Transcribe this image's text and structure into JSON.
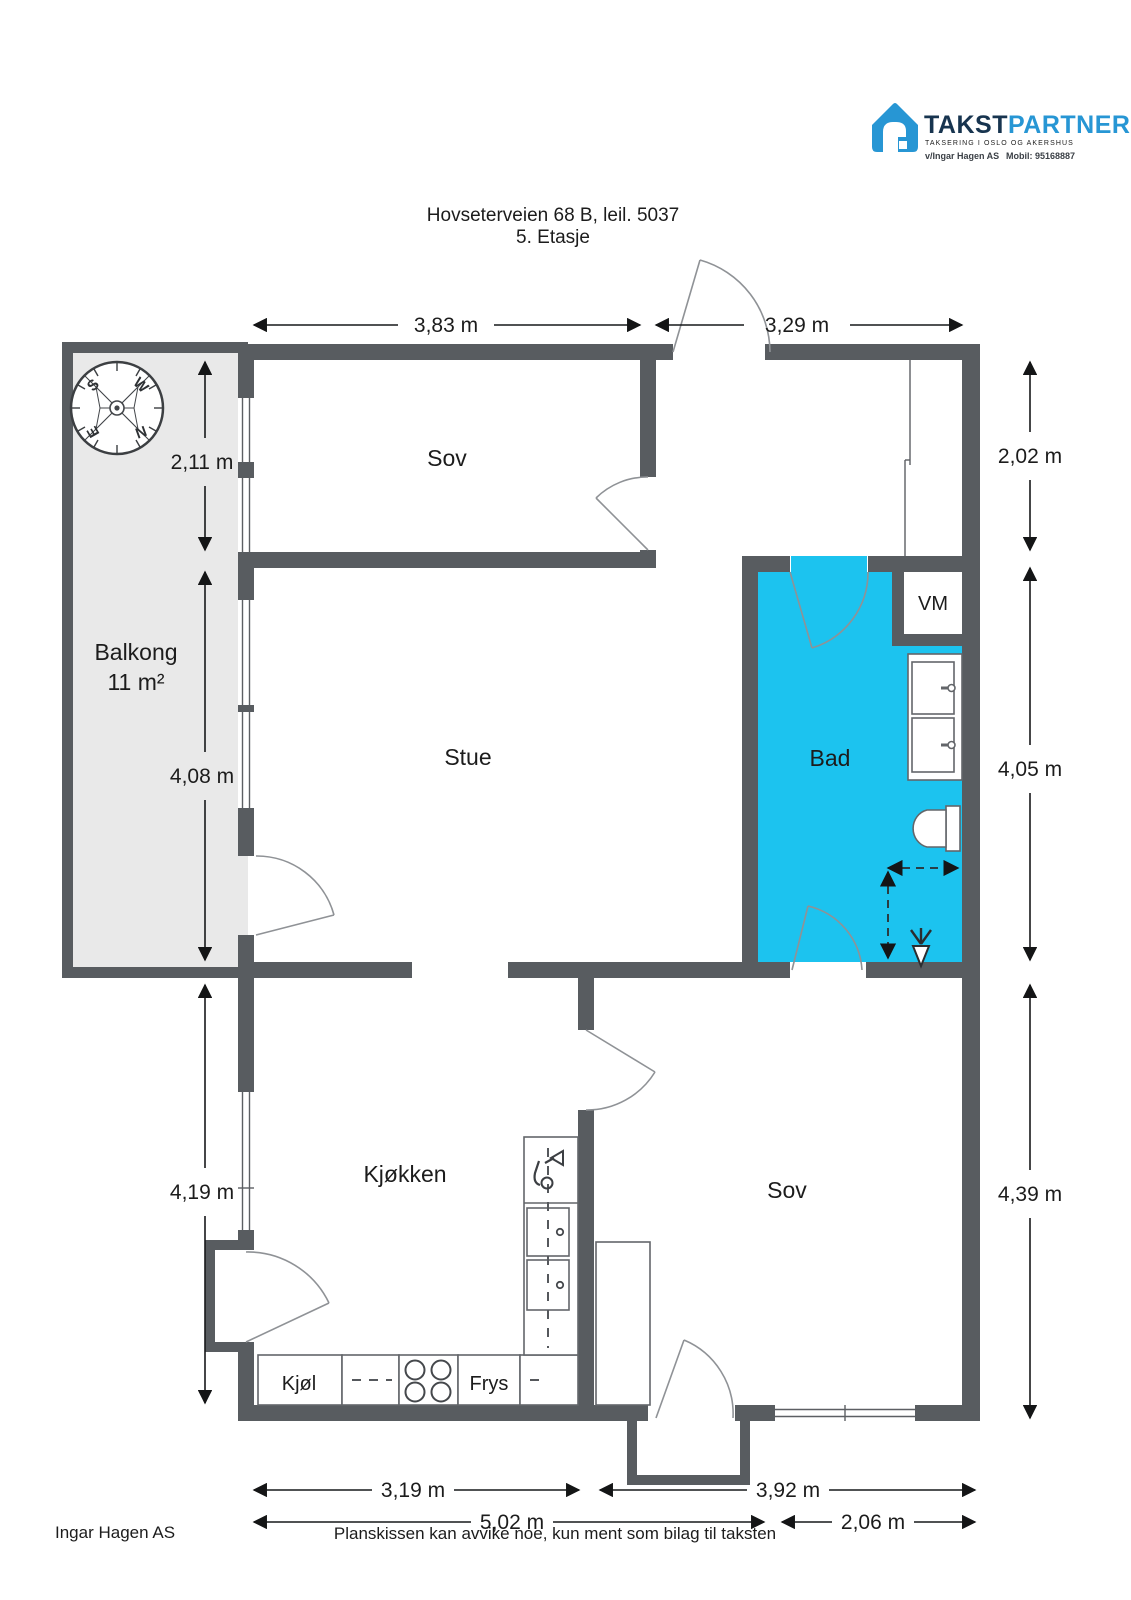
{
  "logo": {
    "brand_primary": "TAKST",
    "brand_secondary": "PARTNER",
    "tagline": "TAKSERING I OSLO OG AKERSHUS",
    "contact_name": "v/Ingar Hagen AS",
    "contact_mobile": "Mobil: 95168887"
  },
  "header": {
    "address": "Hovseterveien 68 B, leil. 5037",
    "floor": "5. Etasje"
  },
  "rooms": {
    "bedroom_top": "Sov",
    "balcony_name": "Balkong",
    "balcony_area": "11 m²",
    "living": "Stue",
    "bath": "Bad",
    "washing_machine": "VM",
    "kitchen": "Kjøkken",
    "bedroom_bottom": "Sov",
    "fridge": "Kjøl",
    "freezer": "Frys"
  },
  "compass": {
    "n": "N",
    "s": "S",
    "e": "E",
    "w": "W"
  },
  "dimensions": {
    "top_left": "3,83 m",
    "top_right": "3,29 m",
    "left_upper": "2,11 m",
    "left_middle": "4,08 m",
    "left_lower": "4,19 m",
    "right_upper": "2,02 m",
    "right_middle": "4,05 m",
    "right_lower": "4,39 m",
    "bottom_kitchen": "3,19 m",
    "bottom_bedroom": "3,92 m",
    "bottom_total_left": "5,02 m",
    "bottom_total_right": "2,06 m"
  },
  "footer": {
    "company": "Ingar Hagen AS",
    "disclaimer": "Planskissen kan avvike noe, kun ment som bilag til taksten"
  },
  "colors": {
    "wall": "#585c60",
    "bath_fill": "#1cc3ef",
    "balcony_fill": "#e9e9e9",
    "logo_navy": "#17344f",
    "logo_blue": "#2796d4"
  }
}
